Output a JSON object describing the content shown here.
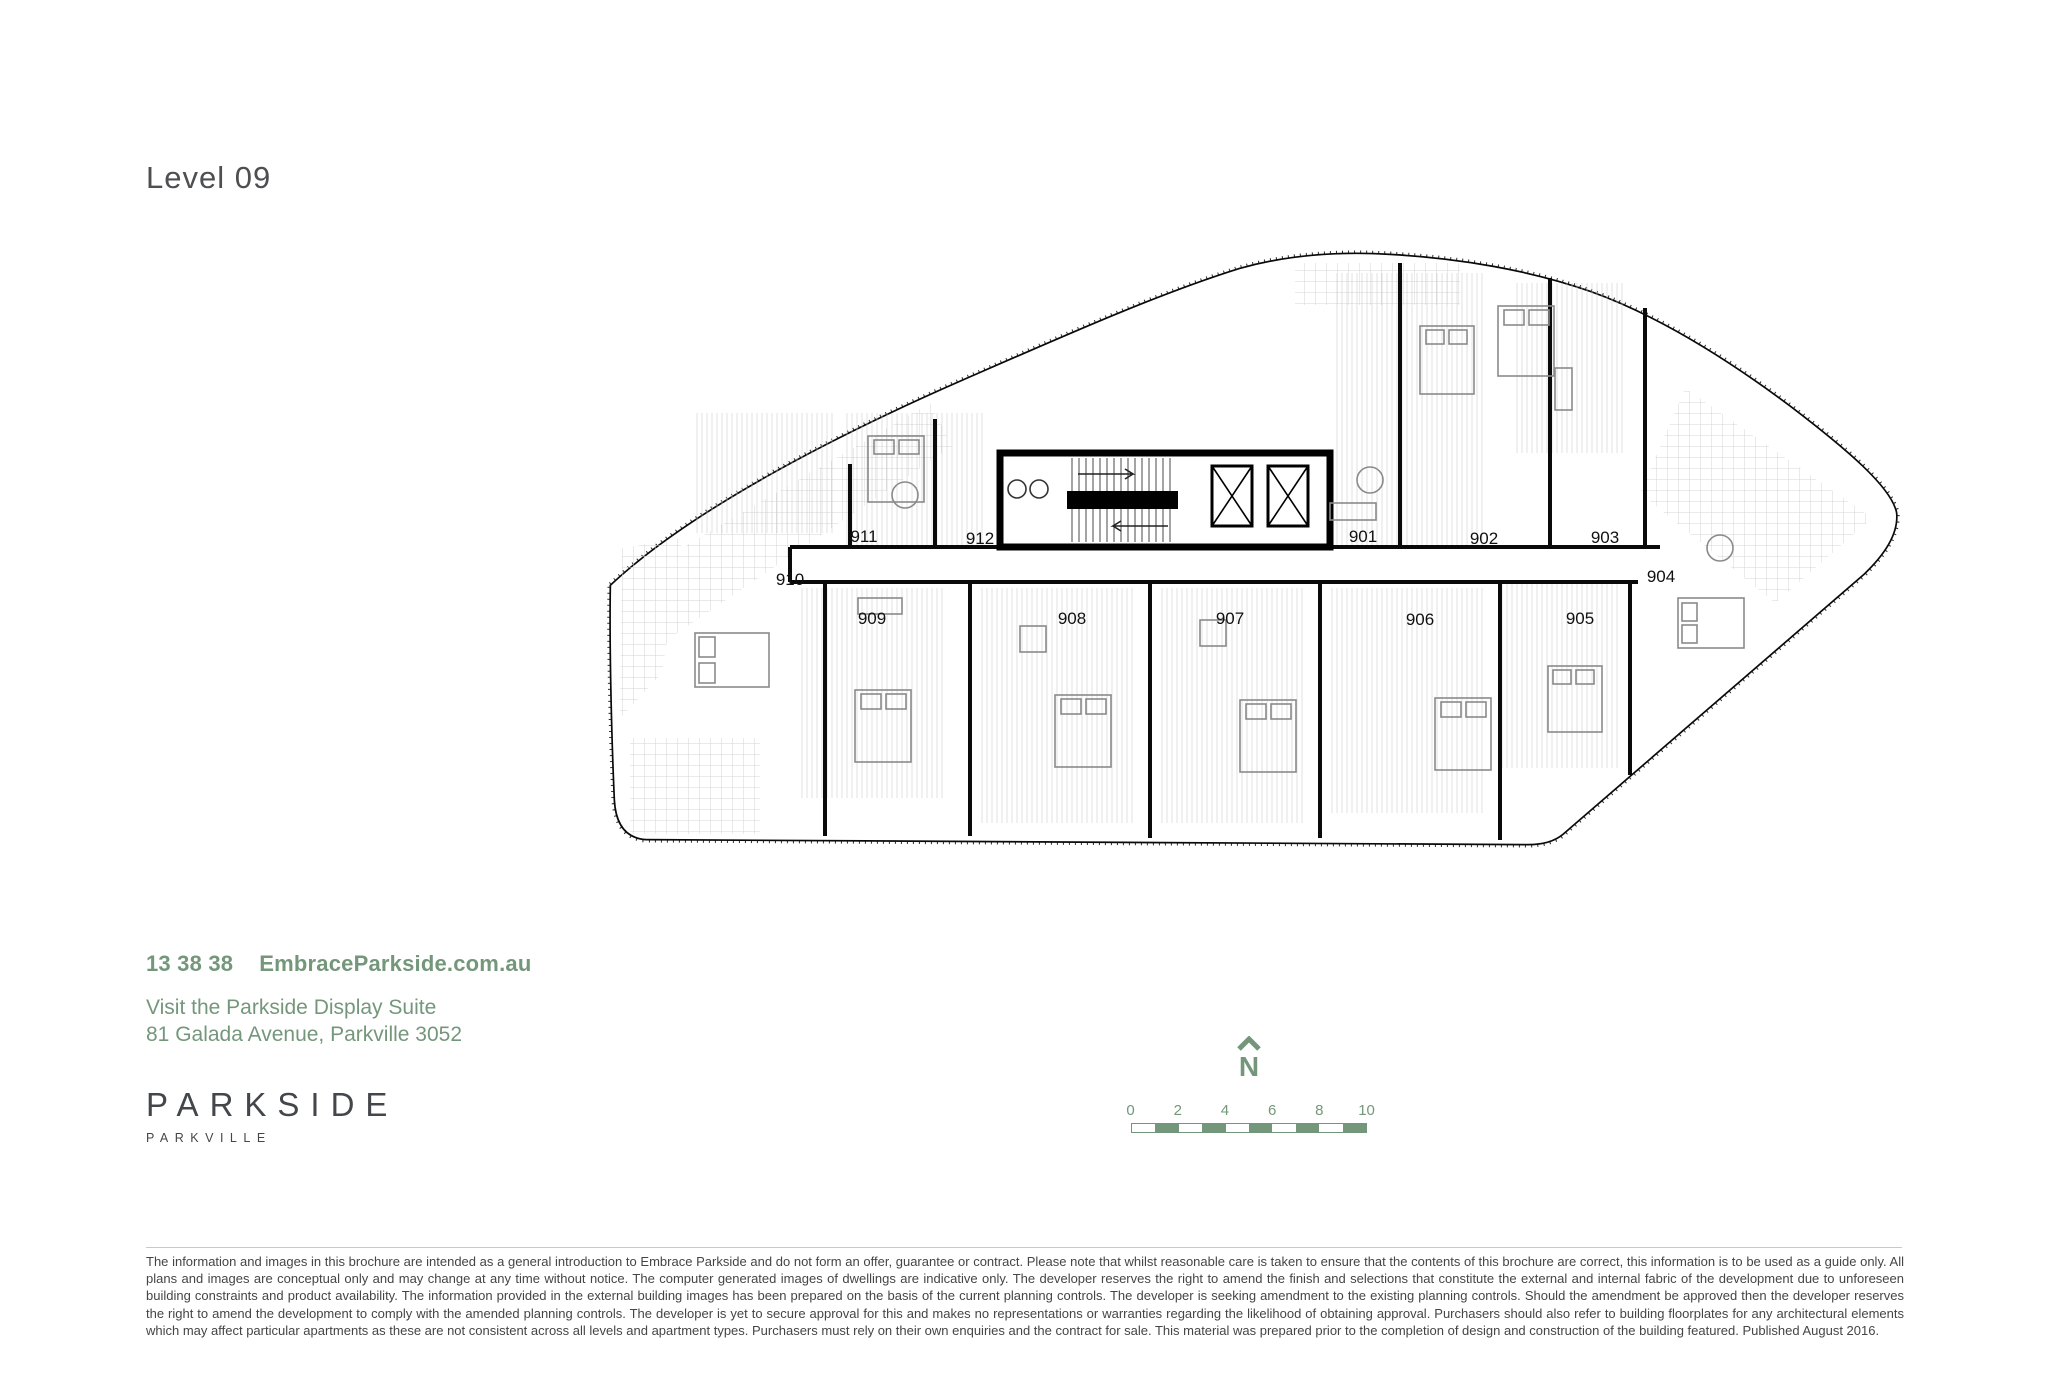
{
  "page": {
    "title": "Level 09"
  },
  "plan": {
    "units": [
      {
        "label": "901"
      },
      {
        "label": "902"
      },
      {
        "label": "903"
      },
      {
        "label": "904"
      },
      {
        "label": "905"
      },
      {
        "label": "906"
      },
      {
        "label": "907"
      },
      {
        "label": "908"
      },
      {
        "label": "909"
      },
      {
        "label": "910"
      },
      {
        "label": "911"
      },
      {
        "label": "912"
      }
    ]
  },
  "contact": {
    "phone": "13 38 38",
    "website": "EmbraceParkside.com.au",
    "visit_line": "Visit the Parkside Display Suite",
    "address_line": "81 Galada Avenue, Parkville 3052"
  },
  "brand": {
    "name": "PARKSIDE",
    "suburb": "PARKVILLE"
  },
  "compass": {
    "label": "N"
  },
  "scale_bar": {
    "ticks": [
      "0",
      "2",
      "4",
      "6",
      "8",
      "10"
    ]
  },
  "disclaimer": "The information and images in this brochure are intended as a general introduction to Embrace Parkside and do not form an offer, guarantee or contract. Please note that whilst reasonable care is taken to ensure that the contents of this brochure are correct, this information is to be used as a guide only. All plans and images are conceptual only and may change at any time without notice. The computer generated images of dwellings are indicative only. The developer reserves the right to amend the finish and selections that constitute the external and internal fabric of the development due to unforeseen building constraints and product availability. The information provided in the external building images has been prepared on the basis of the current planning controls. The developer is seeking amendment to the existing planning controls. Should the amendment be approved then the developer reserves the right to amend the development to comply with the amended planning controls. The developer is yet to secure approval for this and makes no representations or warranties regarding the likelihood of obtaining approval. Purchasers should also refer to building floorplates for any architectural elements which may affect particular apartments as these are not consistent across all levels and apartment types. Purchasers must rely on their own enquiries and the contract for sale. This material was prepared prior to the completion of design and construction of the building featured. Published August 2016.",
  "colors": {
    "accent_green": "#74977B",
    "plan_ink": "#0a0a0a",
    "title_gray": "#4e4f51",
    "logo_charcoal": "#43474b"
  }
}
